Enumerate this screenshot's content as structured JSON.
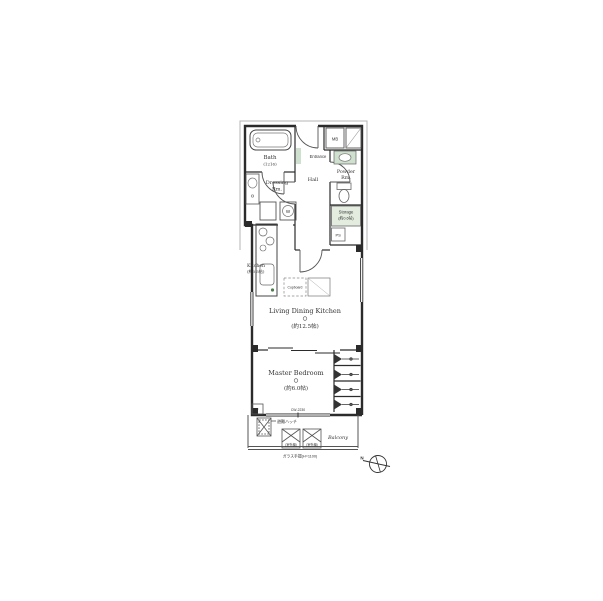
{
  "plan": {
    "rooms": {
      "bath": {
        "name": "Bath",
        "size": "(1216)"
      },
      "dressing": {
        "name": "Dressing",
        "name2": "Rm."
      },
      "entrance": {
        "name": "Entrance"
      },
      "hall": {
        "name": "Hall"
      },
      "powder": {
        "name": "Powder",
        "name2": "Rm."
      },
      "mb": {
        "name": "MB"
      },
      "storage": {
        "name": "Storage",
        "size": "(約0.6帖)"
      },
      "ps": {
        "name": "PS"
      },
      "kitchen": {
        "name": "Kitchen",
        "size": "(約3.5帖)"
      },
      "ldk": {
        "name": "Living Dining Kitchen",
        "size": "(約12.5帖)"
      },
      "bedroom": {
        "name": "Master Bedroom",
        "size": "(約6.0帖)"
      },
      "balcony": {
        "name": "Balcony"
      }
    },
    "fixtures": {
      "washer": "W",
      "fixed_window": "F",
      "cupboard": "Cupboard",
      "outdoor_unit": "(室外機)",
      "hatch_note": "避難ハッチ",
      "railing_note": "ガラス手摺(H=1100)",
      "window_label": "CW-2230"
    },
    "compass": {
      "north": "N"
    },
    "colors": {
      "line": "#2b2b2b",
      "accent_green": "#cfe0cf",
      "muted_gray": "#9a9a9a"
    }
  }
}
